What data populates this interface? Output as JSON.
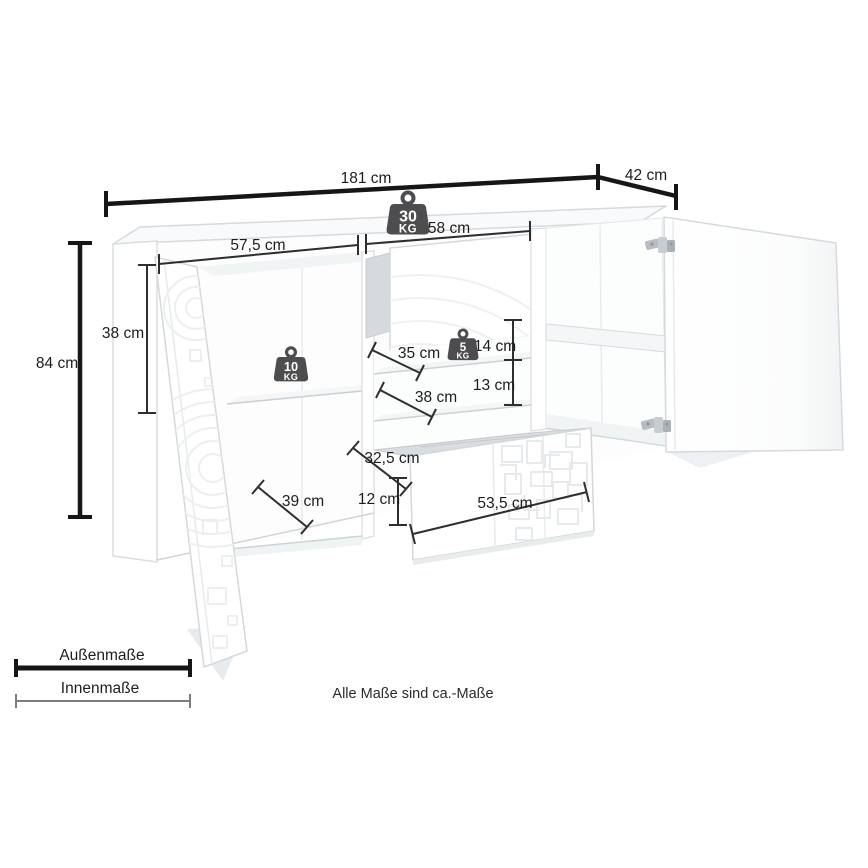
{
  "note": "Alle Maße sind ca.-Maße",
  "legend": {
    "outer": "Außenmaße",
    "inner": "Innenmaße"
  },
  "weights": {
    "total": {
      "value": "30",
      "unit": "KG"
    },
    "left_shelf": {
      "value": "10",
      "unit": "KG"
    },
    "middle_shelf": {
      "value": "5",
      "unit": "KG"
    }
  },
  "dims": {
    "total_width": "181 cm",
    "total_depth": "42 cm",
    "total_height": "84 cm",
    "left_inner_height": "38 cm",
    "left_inner_width": "57,5 cm",
    "middle_inner_width": "58 cm",
    "middle_upper_depth": "35 cm",
    "middle_gap_upper": "14 cm",
    "middle_gap_lower": "13 cm",
    "middle_lower_depth": "38 cm",
    "left_shelf_depth": "39 cm",
    "drawer_depth": "32,5 cm",
    "drawer_inner_height": "12 cm",
    "drawer_inner_width": "53,5 cm"
  },
  "icons": {
    "weight": "kettlebell-weight-icon",
    "hinge": "door-hinge"
  },
  "colors": {
    "outer_line": "#161616",
    "inner_line": "#2e2e2e",
    "legend_inner": "#7c7c7c",
    "weight_icon": "#4d4d4f",
    "edge": "#d3d8db",
    "edge_dark": "#c6cccf",
    "shade": "#f2f4f5",
    "cavity": "#dadde0"
  }
}
